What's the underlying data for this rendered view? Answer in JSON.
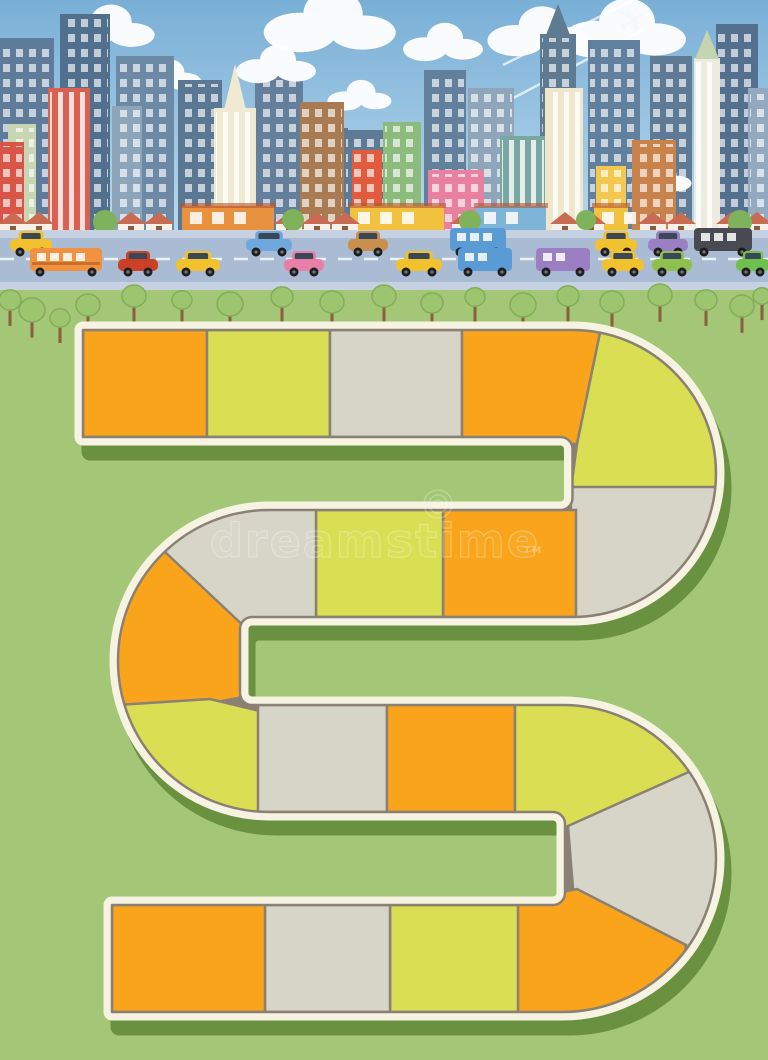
{
  "title": "City board game path illustration",
  "watermark": {
    "text": "dreamstime",
    "tm": "TM"
  },
  "sky": {
    "top": "#79AFD6",
    "bottom": "#CBE4F2"
  },
  "plane": {
    "glyph": "✈",
    "x": 627,
    "y": 40,
    "rotate": -33,
    "color": "#F4F8FB"
  },
  "contrails": [
    [
      500,
      105,
      643,
      30
    ],
    [
      503,
      65,
      633,
      0
    ]
  ],
  "clouds": [
    [
      88,
      22,
      46
    ],
    [
      300,
      14,
      66
    ],
    [
      425,
      38,
      40
    ],
    [
      516,
      26,
      52
    ],
    [
      596,
      22,
      62
    ],
    [
      152,
      72,
      34
    ],
    [
      258,
      60,
      40
    ],
    [
      345,
      92,
      32
    ],
    [
      648,
      175,
      30
    ]
  ],
  "buildings": {
    "back": [
      [
        0,
        38,
        54,
        "#5E7C99",
        "win"
      ],
      [
        60,
        14,
        50,
        "#50708E",
        "win"
      ],
      [
        116,
        56,
        58,
        "#6C8AA6",
        "win"
      ],
      [
        178,
        80,
        44,
        "#5A7893",
        "win"
      ],
      [
        255,
        76,
        48,
        "#637F9C",
        "win"
      ],
      [
        306,
        128,
        42,
        "#5E7A95",
        "win"
      ],
      [
        424,
        70,
        42,
        "#62809B",
        "win"
      ],
      [
        468,
        88,
        46,
        "#8FA5BA",
        "win"
      ],
      [
        588,
        40,
        52,
        "#60809E",
        "win"
      ],
      [
        650,
        56,
        42,
        "#5E7A95",
        "win"
      ],
      [
        716,
        24,
        42,
        "#53718E",
        "win"
      ],
      [
        748,
        88,
        20,
        "#93A9BF",
        "win"
      ]
    ],
    "front": [
      [
        48,
        88,
        42,
        "#DA6051",
        "stripe"
      ],
      [
        8,
        124,
        28,
        "#C9D6B4",
        "win"
      ],
      [
        0,
        142,
        24,
        "#D95548",
        "win"
      ],
      [
        112,
        106,
        30,
        "#8DA5BB",
        "win"
      ],
      [
        214,
        108,
        42,
        "#F1EAD3",
        "stripe",
        "spire"
      ],
      [
        300,
        102,
        44,
        "#A87B52",
        "win"
      ],
      [
        344,
        130,
        44,
        "#5E7A95",
        "win"
      ],
      [
        383,
        122,
        38,
        "#8CBC7D",
        "win"
      ],
      [
        352,
        150,
        30,
        "#E25B3E",
        "win"
      ],
      [
        540,
        34,
        36,
        "#5F7B91",
        "win",
        "spire2"
      ],
      [
        500,
        136,
        46,
        "#79A7A2",
        "stripe"
      ],
      [
        545,
        88,
        38,
        "#EFE6CB",
        "stripe"
      ],
      [
        596,
        166,
        30,
        "#F3C84E",
        "win"
      ],
      [
        632,
        140,
        44,
        "#C8834C",
        "win"
      ],
      [
        694,
        58,
        26,
        "#EDEADF",
        "stripe",
        "greencap"
      ],
      [
        428,
        170,
        56,
        "#E880A0",
        "win"
      ],
      [
        752,
        100,
        16,
        "#93A9BF",
        "win"
      ]
    ]
  },
  "houses": [
    0,
    26,
    118,
    146,
    276,
    304,
    332,
    452,
    552,
    578,
    640,
    668,
    718,
    744
  ],
  "shops": [
    {
      "x": 182,
      "w": 92,
      "c": "#E8923F"
    },
    {
      "x": 350,
      "w": 94,
      "c": "#F2C23E"
    },
    {
      "x": 476,
      "w": 70,
      "c": "#7FB4D9"
    },
    {
      "x": 594,
      "w": 34,
      "c": "#F2C23E"
    }
  ],
  "midTrees": [
    [
      105,
      222,
      12
    ],
    [
      293,
      220,
      11
    ],
    [
      470,
      221,
      11
    ],
    [
      586,
      220,
      10
    ],
    [
      740,
      222,
      12
    ]
  ],
  "road": {
    "sidewalk": "#C6D2E2",
    "asphalt": "#A9BCD4",
    "dash": "#EDF2F7"
  },
  "vehicles": {
    "lane1": [
      {
        "k": "car",
        "c": "#F2C12E",
        "x": 10,
        "w": 42
      },
      {
        "k": "car",
        "c": "#6FA8DC",
        "x": 246,
        "w": 46
      },
      {
        "k": "car",
        "c": "#C98F4F",
        "x": 348,
        "w": 40
      },
      {
        "k": "bus",
        "c": "#5B9BD5",
        "x": 450,
        "w": 56
      },
      {
        "k": "car",
        "c": "#F2C12E",
        "x": 595,
        "w": 42
      },
      {
        "k": "car",
        "c": "#9A7FC2",
        "x": 648,
        "w": 40
      },
      {
        "k": "bus",
        "c": "#4A4A52",
        "x": 694,
        "w": 58
      }
    ],
    "lane2": [
      {
        "k": "sbus",
        "c": "#F0923F",
        "x": 30,
        "w": 72
      },
      {
        "k": "car",
        "c": "#CC4125",
        "x": 118,
        "w": 40
      },
      {
        "k": "car",
        "c": "#F2C12E",
        "x": 176,
        "w": 44
      },
      {
        "k": "car",
        "c": "#E87FA8",
        "x": 284,
        "w": 40
      },
      {
        "k": "car",
        "c": "#F2C12E",
        "x": 396,
        "w": 46
      },
      {
        "k": "bus",
        "c": "#5B9BD5",
        "x": 458,
        "w": 54
      },
      {
        "k": "bus",
        "c": "#9A7FC2",
        "x": 536,
        "w": 54
      },
      {
        "k": "car",
        "c": "#F2C12E",
        "x": 602,
        "w": 42
      },
      {
        "k": "car",
        "c": "#8FBF4F",
        "x": 652,
        "w": 40
      },
      {
        "k": "car",
        "c": "#70C050",
        "x": 736,
        "w": 34
      }
    ]
  },
  "trees": [
    [
      10,
      300,
      11
    ],
    [
      32,
      310,
      13
    ],
    [
      60,
      318,
      10
    ],
    [
      88,
      305,
      12
    ],
    [
      134,
      296,
      12
    ],
    [
      182,
      300,
      10
    ],
    [
      230,
      304,
      13
    ],
    [
      282,
      297,
      11
    ],
    [
      332,
      302,
      12
    ],
    [
      384,
      296,
      12
    ],
    [
      432,
      303,
      11
    ],
    [
      475,
      297,
      10
    ],
    [
      523,
      305,
      13
    ],
    [
      568,
      296,
      11
    ],
    [
      612,
      302,
      12
    ],
    [
      660,
      295,
      12
    ],
    [
      706,
      300,
      11
    ],
    [
      742,
      306,
      12
    ],
    [
      762,
      296,
      9
    ]
  ],
  "field": {
    "color": "#A3C776"
  },
  "path": {
    "tileColors": {
      "O": "#FAA41C",
      "Y": "#D9DE52",
      "G": "#D7D5C8"
    },
    "sequence": [
      "O",
      "Y",
      "G",
      "O",
      "Y",
      "G",
      "O",
      "Y",
      "G",
      "O",
      "Y",
      "G",
      "O",
      "Y",
      "G",
      "O",
      "Y",
      "G",
      "O"
    ],
    "border": "#8A8073",
    "outline": "#F7F3E3",
    "shadow": "#6A9140"
  }
}
